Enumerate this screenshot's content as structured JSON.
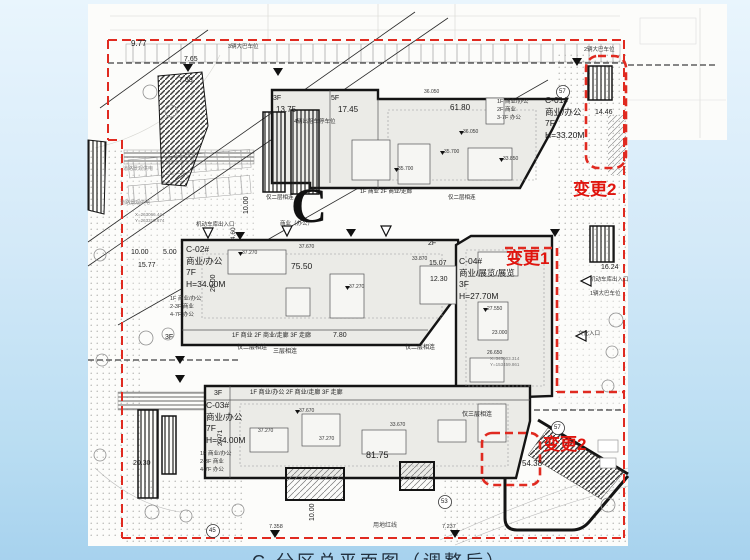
{
  "title": {
    "caption": "C 分区总平面图（调整后）"
  },
  "zone_letter": "C",
  "colors": {
    "change_red": "#e0150e",
    "boundary_red": "#e02a20",
    "ink": "#1b1b1b",
    "building_fill": "#ebebe7",
    "sheet_white": "#fcfcfa",
    "bg_blue": "#cfe8f8"
  },
  "buildings": [
    {
      "id": "C-01#",
      "use": "商业/办公",
      "floors": "7F",
      "height": "H=33.20M",
      "x": 545,
      "y": 96
    },
    {
      "id": "C-02#",
      "use": "商业/办公",
      "floors": "7F",
      "height": "H=34.00M",
      "x": 186,
      "y": 245
    },
    {
      "id": "C-03#",
      "use": "商业/办公",
      "floors": "7F",
      "height": "H=34.00M",
      "x": 206,
      "y": 401
    },
    {
      "id": "C-04#",
      "use": "商业/展览/展览",
      "floors": "3F",
      "height": "H=27.70M",
      "x": 459,
      "y": 257
    }
  ],
  "changes": [
    {
      "label": "变更2",
      "x": 573,
      "y": 181
    },
    {
      "label": "变更1",
      "x": 506,
      "y": 250
    },
    {
      "label": "变更2",
      "x": 543,
      "y": 436
    }
  ],
  "labels": [
    {
      "n": "dim-label",
      "t": "9.77",
      "x": 131,
      "y": 40,
      "s": 8
    },
    {
      "n": "dim-label",
      "t": "7.65",
      "x": 184,
      "y": 56,
      "s": 7
    },
    {
      "n": "dim-label",
      "t": "7.65",
      "x": 179,
      "y": 77,
      "s": 7
    },
    {
      "n": "dim-label",
      "t": "13.75",
      "x": 276,
      "y": 106,
      "s": 8
    },
    {
      "n": "dim-label",
      "t": "17.45",
      "x": 338,
      "y": 106,
      "s": 8
    },
    {
      "n": "dim-label",
      "t": "61.80",
      "x": 450,
      "y": 104,
      "s": 8
    },
    {
      "n": "dim-label",
      "t": "14.46",
      "x": 595,
      "y": 109,
      "s": 7
    },
    {
      "n": "dim-label",
      "t": "10.00",
      "x": 131,
      "y": 249,
      "s": 7
    },
    {
      "n": "dim-label",
      "t": "5.00",
      "x": 163,
      "y": 249,
      "s": 7
    },
    {
      "n": "dim-label",
      "t": "15.77",
      "x": 138,
      "y": 262,
      "s": 7
    },
    {
      "n": "dim-label",
      "t": "75.50",
      "x": 291,
      "y": 262,
      "s": 8.5
    },
    {
      "n": "dim-label",
      "t": "28.00",
      "x": 210,
      "y": 292,
      "s": 7,
      "r": -90
    },
    {
      "n": "dim-label",
      "t": "10.00",
      "x": 243,
      "y": 214,
      "s": 7,
      "r": -90
    },
    {
      "n": "dim-label",
      "t": "4.60",
      "x": 231,
      "y": 240,
      "s": 6.5,
      "r": -90
    },
    {
      "n": "dim-label",
      "t": "15.07",
      "x": 429,
      "y": 260,
      "s": 7
    },
    {
      "n": "dim-label",
      "t": "12.30",
      "x": 430,
      "y": 276,
      "s": 7
    },
    {
      "n": "dim-label",
      "t": "16.24",
      "x": 601,
      "y": 264,
      "s": 7
    },
    {
      "n": "dim-label",
      "t": "7.80",
      "x": 333,
      "y": 332,
      "s": 7
    },
    {
      "n": "dim-label",
      "t": "20.30",
      "x": 133,
      "y": 460,
      "s": 7
    },
    {
      "n": "dim-label",
      "t": "27.71",
      "x": 218,
      "y": 446,
      "s": 6.5,
      "r": -90
    },
    {
      "n": "dim-label",
      "t": "81.75",
      "x": 366,
      "y": 451,
      "s": 9
    },
    {
      "n": "dim-label",
      "t": "54.38",
      "x": 522,
      "y": 460,
      "s": 8
    },
    {
      "n": "dim-label",
      "t": "7.358",
      "x": 269,
      "y": 525,
      "s": 5.5,
      "c": "#333333"
    },
    {
      "n": "dim-label",
      "t": "7.237",
      "x": 442,
      "y": 525,
      "s": 5.5,
      "c": "#333333"
    },
    {
      "n": "dim-label",
      "t": "10.00",
      "x": 309,
      "y": 521,
      "s": 7,
      "r": -90
    },
    {
      "n": "floor-label",
      "t": "3F",
      "x": 273,
      "y": 95,
      "s": 7
    },
    {
      "n": "floor-label",
      "t": "5F",
      "x": 331,
      "y": 95,
      "s": 7
    },
    {
      "n": "floor-label",
      "t": "2F",
      "x": 428,
      "y": 240,
      "s": 7
    },
    {
      "n": "floor-label",
      "t": "3F",
      "x": 214,
      "y": 390,
      "s": 7
    },
    {
      "n": "floor-label",
      "t": "3F",
      "x": 165,
      "y": 334,
      "s": 7
    },
    {
      "n": "usage-label",
      "t": "1F 商业/办公",
      "x": 497,
      "y": 100,
      "s": 5.5,
      "c": "#333333"
    },
    {
      "n": "usage-label",
      "t": "2F 商业",
      "x": 497,
      "y": 108,
      "s": 5.5,
      "c": "#333333"
    },
    {
      "n": "usage-label",
      "t": "3-7F 办公",
      "x": 497,
      "y": 116,
      "s": 5.5,
      "c": "#333333"
    },
    {
      "n": "usage-label",
      "t": "1F 商业/办公",
      "x": 170,
      "y": 297,
      "s": 5.5,
      "c": "#333333"
    },
    {
      "n": "usage-label",
      "t": "2-3F 商业",
      "x": 170,
      "y": 305,
      "s": 5.5,
      "c": "#333333"
    },
    {
      "n": "usage-label",
      "t": "4-7F 办公",
      "x": 170,
      "y": 313,
      "s": 5.5,
      "c": "#333333"
    },
    {
      "n": "usage-label",
      "t": "1F 商业/办公",
      "x": 200,
      "y": 452,
      "s": 5.5,
      "c": "#333333"
    },
    {
      "n": "usage-label",
      "t": "2-3F 商业",
      "x": 200,
      "y": 460,
      "s": 5.5,
      "c": "#333333"
    },
    {
      "n": "usage-label",
      "t": "4-7F 办公",
      "x": 200,
      "y": 468,
      "s": 5.5,
      "c": "#333333"
    },
    {
      "n": "usage-label",
      "t": "1F 商业 2F 商业/走廊 3F 走廊",
      "x": 232,
      "y": 333,
      "s": 6,
      "c": "#222222"
    },
    {
      "n": "usage-label",
      "t": "1F 商业/办公 2F 商业/走廊 3F 走廊",
      "x": 250,
      "y": 390,
      "s": 6,
      "c": "#222222"
    },
    {
      "n": "usage-label",
      "t": "1F 商业 2F 商业/走廊",
      "x": 360,
      "y": 190,
      "s": 5.5,
      "c": "#222222"
    },
    {
      "n": "note-label",
      "t": "仅二层相连",
      "x": 237,
      "y": 345,
      "s": 6,
      "c": "#222222"
    },
    {
      "n": "note-label",
      "t": "三层相连",
      "x": 273,
      "y": 349,
      "s": 6,
      "c": "#222222"
    },
    {
      "n": "note-label",
      "t": "仅二层相连",
      "x": 405,
      "y": 345,
      "s": 6,
      "c": "#222222"
    },
    {
      "n": "note-label",
      "t": "仅三层相连",
      "x": 462,
      "y": 412,
      "s": 6,
      "c": "#222222"
    },
    {
      "n": "note-label",
      "t": "仅二层相连",
      "x": 266,
      "y": 196,
      "s": 5.5,
      "c": "#222222"
    },
    {
      "n": "note-label",
      "t": "仅二层相连",
      "x": 448,
      "y": 196,
      "s": 5.5,
      "c": "#222222"
    },
    {
      "n": "note-label",
      "t": "3辆大巴车位",
      "x": 228,
      "y": 45,
      "s": 5.5,
      "c": "#333333"
    },
    {
      "n": "note-label",
      "t": "2辆大巴车位",
      "x": 584,
      "y": 48,
      "s": 5.5,
      "c": "#333333"
    },
    {
      "n": "note-label",
      "t": "1辆大巴车位",
      "x": 590,
      "y": 292,
      "s": 5.5,
      "c": "#333333"
    },
    {
      "n": "note-label",
      "t": "4辆出租车停车位",
      "x": 294,
      "y": 120,
      "s": 5.5,
      "c": "#333333"
    },
    {
      "n": "note-label",
      "t": "机动车库出入口",
      "x": 196,
      "y": 223,
      "s": 5.5,
      "c": "#333333"
    },
    {
      "n": "note-label",
      "t": "机动车库出入口",
      "x": 590,
      "y": 278,
      "s": 5.5,
      "c": "#333333"
    },
    {
      "n": "note-label",
      "t": "文化入口",
      "x": 578,
      "y": 332,
      "s": 5.5,
      "c": "#333333"
    },
    {
      "n": "note-label",
      "t": "商业（办公）",
      "x": 280,
      "y": 222,
      "s": 5.5,
      "c": "#333333"
    },
    {
      "n": "note-label",
      "t": "用地红线",
      "x": 373,
      "y": 523,
      "s": 6,
      "c": "#444444"
    },
    {
      "n": "note-label",
      "t": "道路景观供电",
      "x": 123,
      "y": 167,
      "s": 5,
      "c": "#888888"
    },
    {
      "n": "note-label",
      "t": "道路景观供电",
      "x": 120,
      "y": 201,
      "s": 5,
      "c": "#888888"
    },
    {
      "n": "coordinate-label",
      "t": "X=263066.444",
      "x": 135,
      "y": 213,
      "s": 4.5,
      "c": "#777777"
    },
    {
      "n": "coordinate-label",
      "t": "Y=263310.674",
      "x": 135,
      "y": 219,
      "s": 4.5,
      "c": "#777777"
    },
    {
      "n": "coordinate-label",
      "t": "X=343003.314",
      "x": 490,
      "y": 357,
      "s": 4.5,
      "c": "#777777"
    },
    {
      "n": "coordinate-label",
      "t": "Y=153459.861",
      "x": 490,
      "y": 363,
      "s": 4.5,
      "c": "#777777"
    },
    {
      "n": "elevation-label",
      "t": "35.700",
      "x": 398,
      "y": 167,
      "s": 5,
      "c": "#333333"
    },
    {
      "n": "elevation-label",
      "t": "35.700",
      "x": 444,
      "y": 150,
      "s": 5,
      "c": "#333333"
    },
    {
      "n": "elevation-label",
      "t": "36.050",
      "x": 463,
      "y": 130,
      "s": 5,
      "c": "#333333"
    },
    {
      "n": "elevation-label",
      "t": "33.850",
      "x": 503,
      "y": 157,
      "s": 5,
      "c": "#333333"
    },
    {
      "n": "elevation-label",
      "t": "36.050",
      "x": 424,
      "y": 90,
      "s": 5,
      "c": "#333333"
    },
    {
      "n": "elevation-label",
      "t": "37.270",
      "x": 242,
      "y": 251,
      "s": 5,
      "c": "#333333"
    },
    {
      "n": "elevation-label",
      "t": "37.670",
      "x": 299,
      "y": 245,
      "s": 5,
      "c": "#333333"
    },
    {
      "n": "elevation-label",
      "t": "37.270",
      "x": 349,
      "y": 285,
      "s": 5,
      "c": "#333333"
    },
    {
      "n": "elevation-label",
      "t": "33.870",
      "x": 412,
      "y": 257,
      "s": 5,
      "c": "#333333"
    },
    {
      "n": "elevation-label",
      "t": "27.550",
      "x": 487,
      "y": 307,
      "s": 5,
      "c": "#333333"
    },
    {
      "n": "elevation-label",
      "t": "23.000",
      "x": 492,
      "y": 331,
      "s": 5,
      "c": "#333333"
    },
    {
      "n": "elevation-label",
      "t": "26.650",
      "x": 487,
      "y": 351,
      "s": 5,
      "c": "#333333"
    },
    {
      "n": "elevation-label",
      "t": "37.670",
      "x": 299,
      "y": 409,
      "s": 5,
      "c": "#333333"
    },
    {
      "n": "elevation-label",
      "t": "37.270",
      "x": 319,
      "y": 437,
      "s": 5,
      "c": "#333333"
    },
    {
      "n": "elevation-label",
      "t": "33.670",
      "x": 390,
      "y": 423,
      "s": 5,
      "c": "#333333"
    },
    {
      "n": "elevation-label",
      "t": "37.270",
      "x": 258,
      "y": 429,
      "s": 5,
      "c": "#333333"
    },
    {
      "n": "circle-number",
      "t": "45",
      "x": 209,
      "y": 528,
      "s": 6,
      "c": "#222222"
    },
    {
      "n": "circle-number",
      "t": "53",
      "x": 441,
      "y": 499,
      "s": 6,
      "c": "#222222"
    },
    {
      "n": "circle-number",
      "t": "57",
      "x": 559,
      "y": 89,
      "s": 6,
      "c": "#222222"
    },
    {
      "n": "circle-number",
      "t": "57",
      "x": 554,
      "y": 425,
      "s": 6,
      "c": "#222222"
    }
  ]
}
